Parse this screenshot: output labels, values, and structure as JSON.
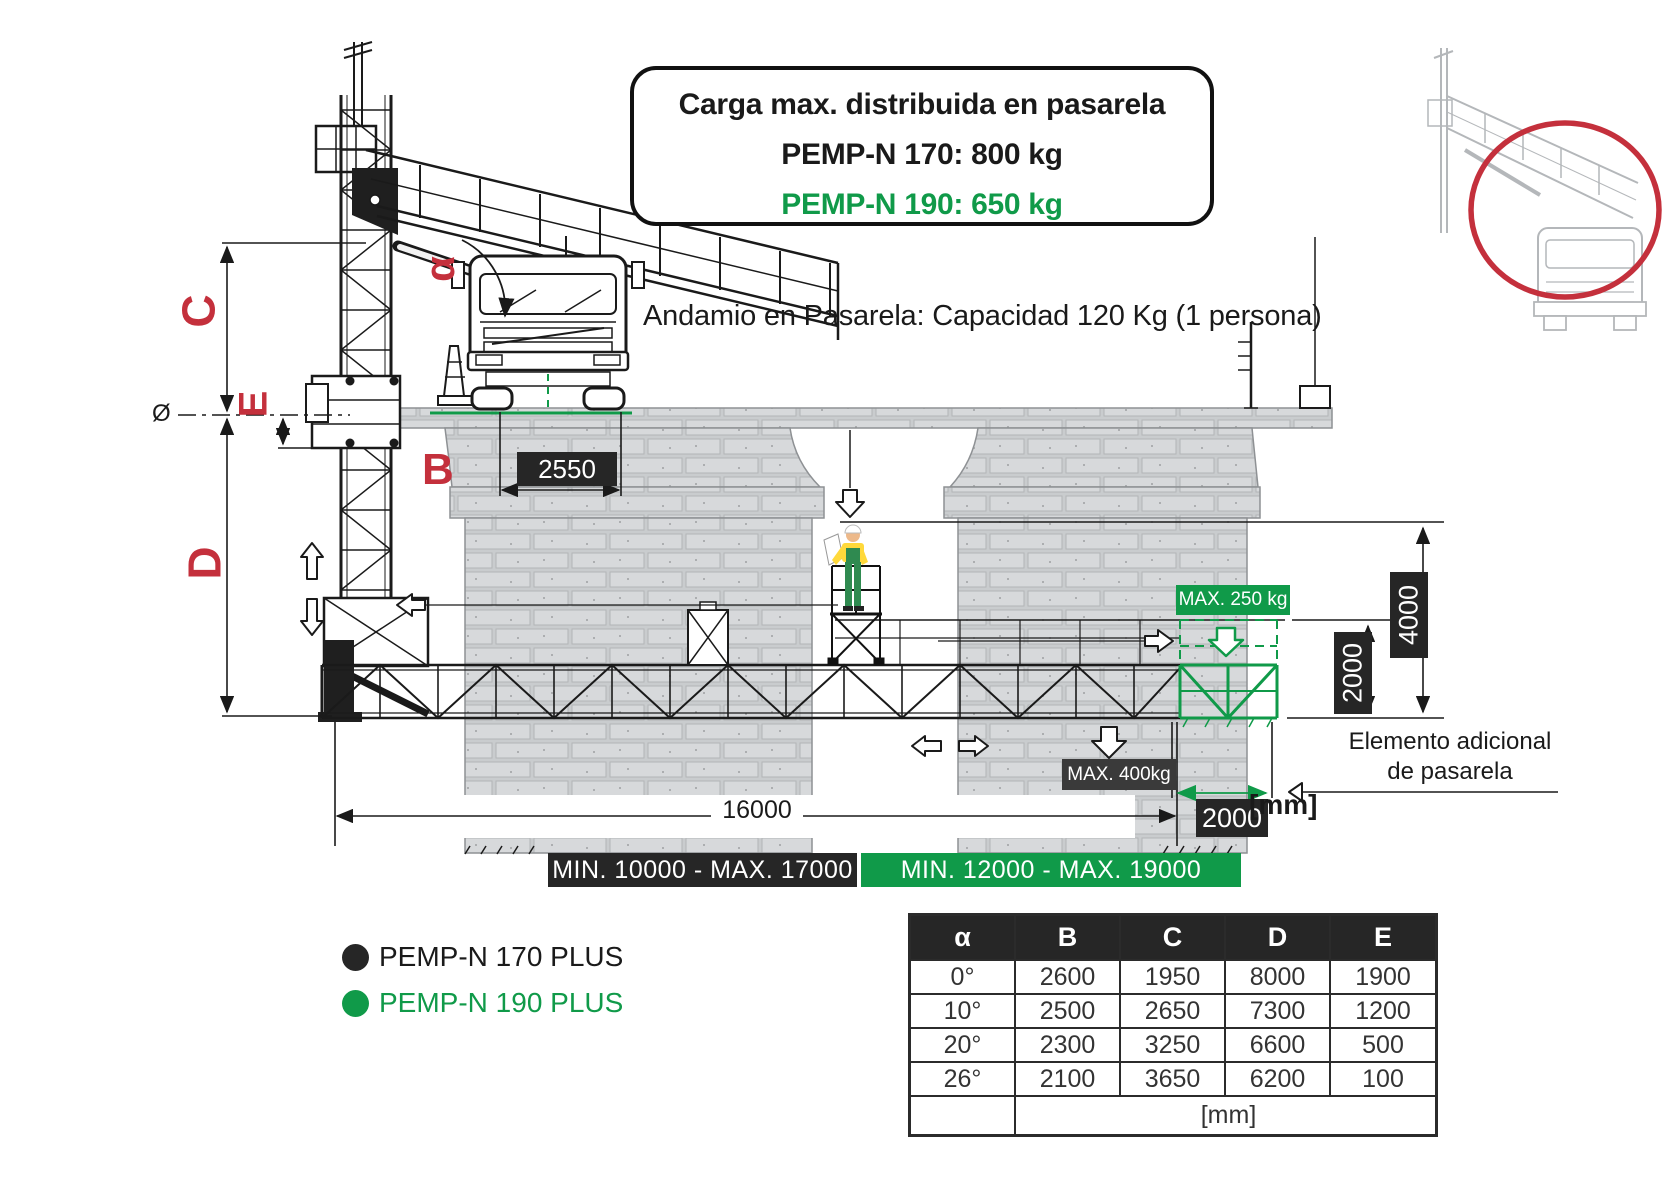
{
  "colors": {
    "green": "#109a49",
    "red": "#c4303c",
    "dark": "#262626",
    "inset_gray": "#b4b7ba",
    "brick_face": "#d7d9db",
    "brick_mortar": "#c9ccce"
  },
  "info_box": {
    "line1": "Carga max. distribuida en pasarela",
    "line2": "PEMP-N 170: 800 kg",
    "line3": "PEMP-N 190: 650 kg"
  },
  "notes": {
    "andamio": "Andamio en Pasarela: Capacidad 120 Kg (1 persona)",
    "elemento_line1": "Elemento adicional",
    "elemento_line2": "de pasarela",
    "units": "[mm]"
  },
  "dim_labels": {
    "alpha": "α",
    "b": "B",
    "c": "C",
    "d": "D",
    "e": "E",
    "diameter": "Ø"
  },
  "badges": {
    "deck_width": "2550",
    "max_upper": "MAX. 250 kg",
    "max_lower": "MAX. 400kg",
    "height_4000": "4000",
    "height_2000": "2000",
    "width_2000": "2000",
    "span_16000": "16000",
    "range_170": "MIN. 10000 - MAX. 17000",
    "range_190": "MIN. 12000 - MAX. 19000"
  },
  "legend": {
    "items": [
      {
        "label": "PEMP-N 170 PLUS",
        "color": "#262626"
      },
      {
        "label": "PEMP-N 190 PLUS",
        "color": "#109a49"
      }
    ]
  },
  "table": {
    "headers": [
      "α",
      "B",
      "C",
      "D",
      "E"
    ],
    "rows": [
      [
        "0°",
        "2600",
        "1950",
        "8000",
        "1900"
      ],
      [
        "10°",
        "2500",
        "2650",
        "7300",
        "1200"
      ],
      [
        "20°",
        "2300",
        "3250",
        "6600",
        "500"
      ],
      [
        "26°",
        "2100",
        "3650",
        "6200",
        "100"
      ]
    ],
    "footer": "[mm]"
  }
}
